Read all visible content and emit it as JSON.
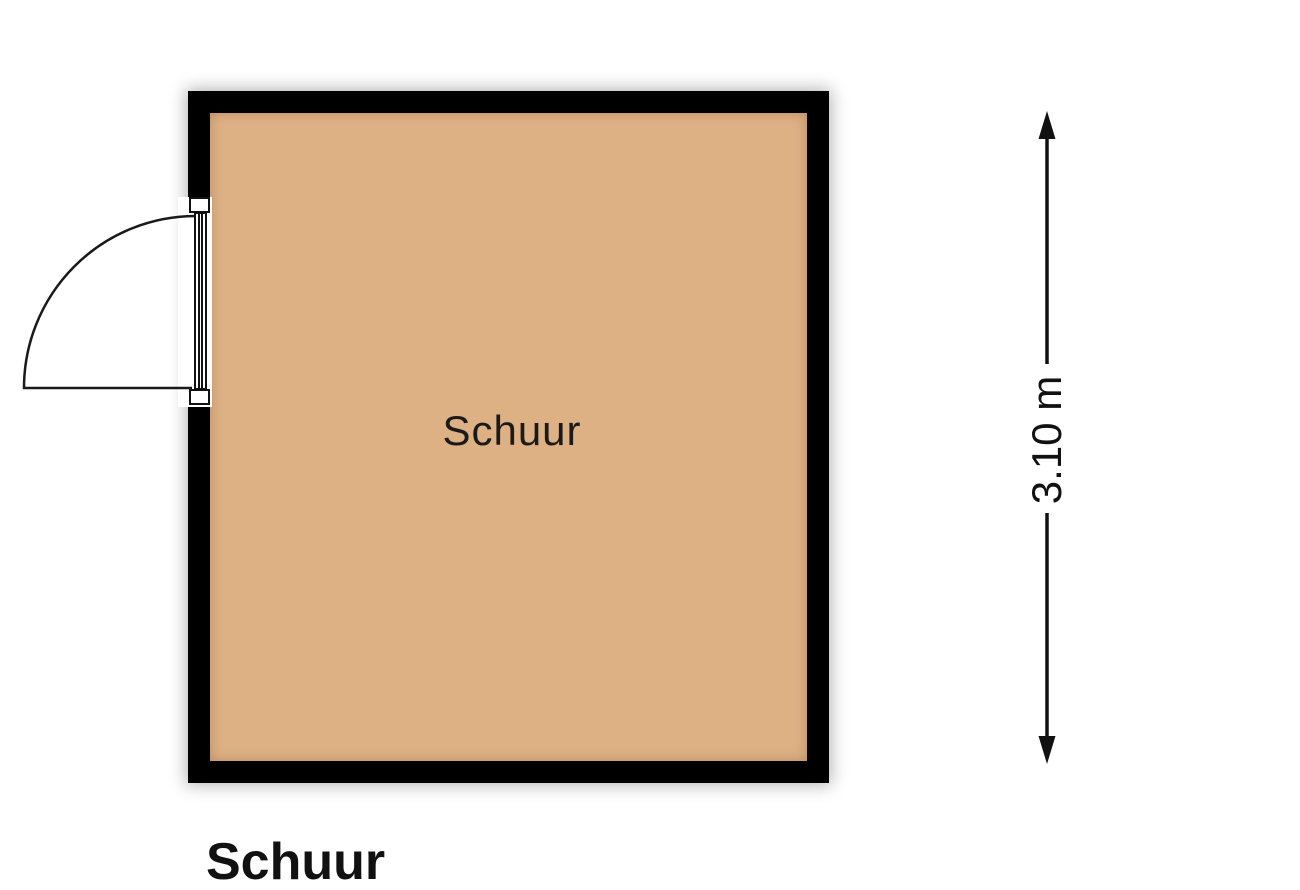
{
  "title": "Schuur",
  "plan": {
    "room": {
      "label": "Schuur",
      "floor_color": "#deb185",
      "wall_color": "#000000"
    },
    "door": {
      "type": "single-swing",
      "wall": "left",
      "swing": "outward"
    },
    "dimension": {
      "value": "3.10 m",
      "axis": "vertical",
      "side": "right"
    }
  }
}
